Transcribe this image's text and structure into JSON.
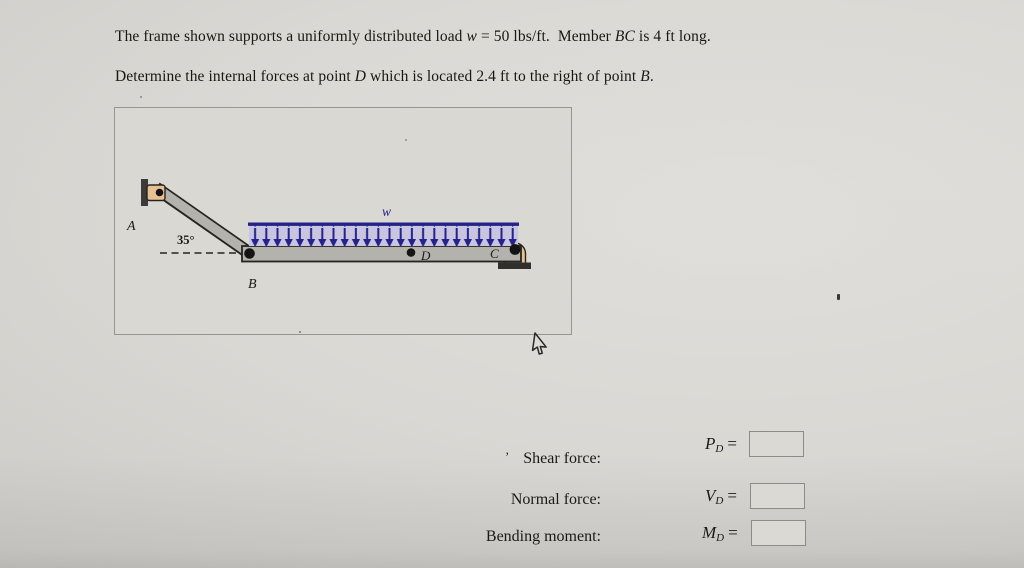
{
  "page": {
    "background": "#d6d4cf",
    "panel_border": "#97958e"
  },
  "problem": {
    "line1": [
      {
        "text": "The frame shown supports a uniformly distributed load "
      },
      {
        "text": "w"
      },
      {
        "text": " = 50 lbs/ft.  Member "
      },
      {
        "text": "BC"
      },
      {
        "text": " is 4 ft long."
      }
    ],
    "line2": [
      {
        "text": "Determine the internal forces at point "
      },
      {
        "text": "D"
      },
      {
        "text": " which is located 2.4 ft to the right of point "
      },
      {
        "text": "B"
      },
      {
        "text": "."
      }
    ]
  },
  "figure": {
    "labels": {
      "A": "A",
      "B": "B",
      "C": "C",
      "D": "D",
      "load": "w",
      "angle": "35°"
    },
    "load": {
      "arrow_count": 24,
      "arrow_color": "#23238a",
      "band_color": "#c9c5e1"
    },
    "colors": {
      "beam": "#b4b2ac",
      "outline": "#26241f",
      "pin": "#141414",
      "bracket_tan": "#e7c194",
      "support_plate": "#3b3b39",
      "base_plate": "#2f2f2d",
      "label_blue": "#23238a"
    }
  },
  "form": {
    "tick": "’",
    "rows": [
      {
        "label": "Shear force:",
        "symbol": "P",
        "subscript": "D",
        "equals": "=",
        "value": ""
      },
      {
        "label": "Normal force:",
        "symbol": "V",
        "subscript": "D",
        "equals": "=",
        "value": ""
      },
      {
        "label": "Bending moment:",
        "symbol": "M",
        "subscript": "D",
        "equals": "=",
        "value": ""
      }
    ]
  },
  "cursor": {
    "icon": "arrow-pointer"
  }
}
